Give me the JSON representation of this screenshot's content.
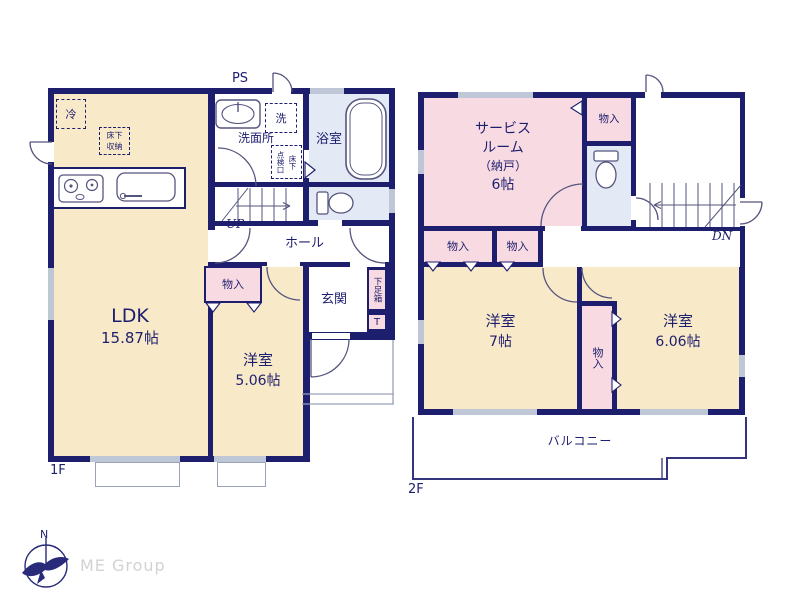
{
  "floor1": {
    "floor_label": "1F",
    "ps": "PS",
    "fridge": "冷",
    "underfloor_line1": "床下",
    "underfloor_line2": "収納",
    "ldk_name": "LDK",
    "ldk_size": "15.87帖",
    "senmenjo": "洗面所",
    "washer": "洗",
    "inspection_hatch": "点検口",
    "underfloor": "床下",
    "bath": "浴室",
    "up": "UP",
    "hall": "ホール",
    "closet": "物入",
    "youshitsu_name": "洋室",
    "youshitsu_size": "5.06帖",
    "genkan": "玄関",
    "shoe_box": "下足箱",
    "toilet_mark": "T"
  },
  "floor2": {
    "floor_label": "2F",
    "service_line1": "サービス",
    "service_line2": "ルーム",
    "service_line3": "（納戸）",
    "service_size": "6帖",
    "closet": "物入",
    "youshitsu7_name": "洋室",
    "youshitsu7_size": "7帖",
    "youshitsu6_name": "洋室",
    "youshitsu6_size": "6.06帖",
    "dn": "DN",
    "balcony": "バルコニー"
  },
  "footer": {
    "brand": "ME Group",
    "compass_north": "N"
  },
  "colors": {
    "wall": "#1e1e6e",
    "room_cream": "#f8e9c8",
    "room_pink": "#f8dbe2",
    "room_blue": "#e3eaf5",
    "window_gray": "#bfc7d6"
  }
}
